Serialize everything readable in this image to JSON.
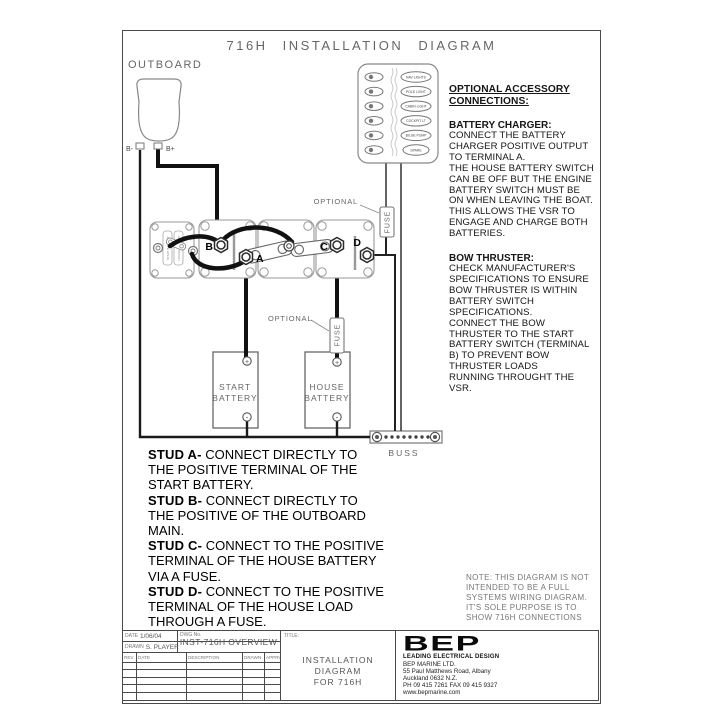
{
  "page": {
    "title": "716H INSTALLATION DIAGRAM"
  },
  "diagram": {
    "outboard": {
      "label": "OUTBOARD",
      "neg": "B-",
      "pos": "B+"
    },
    "panel": {
      "switch_labels": [
        "NAV LIGHTS",
        "POLE LIGHT",
        "CABIN LIGHT",
        "COCKPIT LT",
        "BILGE PUMP",
        "SPARE"
      ]
    },
    "studs": {
      "a": "A",
      "b": "B",
      "c": "C",
      "d": "D"
    },
    "vsr": {
      "label1": "START BATTERY",
      "label2": "HOUSE BATTERY"
    },
    "fuse1": {
      "label": "FUSE",
      "optional": "OPTIONAL"
    },
    "fuse2": {
      "label": "FUSE",
      "optional": "OPTIONAL"
    },
    "start_battery": {
      "line1": "START",
      "line2": "BATTERY",
      "pos": "+",
      "neg": "-"
    },
    "house_battery": {
      "line1": "HOUSE",
      "line2": "BATTERY",
      "pos": "+",
      "neg": "-"
    },
    "buss": {
      "label": "BUSS"
    }
  },
  "accessory_notes": {
    "heading": "OPTIONAL ACCESSORY\nCONNECTIONS:",
    "sections": [
      {
        "title": "BATTERY CHARGER:",
        "body": "CONNECT THE BATTERY\nCHARGER POSITIVE OUTPUT\nTO TERMINAL A.\nTHE HOUSE BATTERY SWITCH\nCAN BE OFF BUT THE ENGINE\nBATTERY SWITCH MUST BE\nON WHEN LEAVING THE BOAT.\nTHIS ALLOWS THE VSR TO\nENGAGE AND CHARGE BOTH\nBATTERIES."
      },
      {
        "title": "BOW THRUSTER:",
        "body": "CHECK MANUFACTURER'S\nSPECIFICATIONS TO ENSURE\nBOW THRUSTER IS WITHIN\nBATTERY SWITCH\nSPECIFICATIONS.\nCONNECT THE BOW\nTHRUSTER TO THE START\nBATTERY SWITCH (TERMINAL\nB) TO PREVENT BOW\nTHRUSTER LOADS\nRUNNING THROUGHT THE\nVSR."
      }
    ]
  },
  "stud_instructions": [
    {
      "label": "STUD A-",
      "rest": " CONNECT DIRECTLY TO\nTHE POSITIVE TERMINAL OF THE\nSTART BATTERY."
    },
    {
      "label": "STUD B-",
      "rest": " CONNECT DIRECTLY TO\nTHE POSITIVE OF THE OUTBOARD\nMAIN."
    },
    {
      "label": "STUD C-",
      "rest": " CONNECT TO THE POSITIVE\nTERMINAL OF THE HOUSE BATTERY\nVIA A FUSE."
    },
    {
      "label": "STUD D-",
      "rest": " CONNECT TO THE POSITIVE\nTERMINAL OF THE HOUSE LOAD\nTHROUGH A FUSE."
    }
  ],
  "note": "NOTE: THIS DIAGRAM IS NOT\nINTENDED TO BE A FULL\nSYSTEMS WIRING DIAGRAM.\nIT'S SOLE PURPOSE IS TO\nSHOW 716H CONNECTIONS",
  "title_block": {
    "date_label": "DATE",
    "date": "1/06/04",
    "drawn_label": "DRAWN",
    "drawn": "S. PLAYER",
    "dwg_label": "DWG No.",
    "dwg": "INST-716H OVERVIEW",
    "rev_headers": [
      "REV",
      "DATE",
      "DESCRIPTION",
      "DRAWN",
      "APPRVD"
    ],
    "title_label": "TITLE:",
    "title": "INSTALLATION DIAGRAM\nFOR 716H",
    "company": {
      "logo": "BEP",
      "tagline": "LEADING ELECTRICAL DESIGN",
      "lines": "BEP MARINE LTD.\n55 Paul Matthews Road, Albany\nAuckland 0632 N.Z.\nPH 09 415 7261 FAX 09 415 9327\nwww.bepmarine.com"
    }
  }
}
